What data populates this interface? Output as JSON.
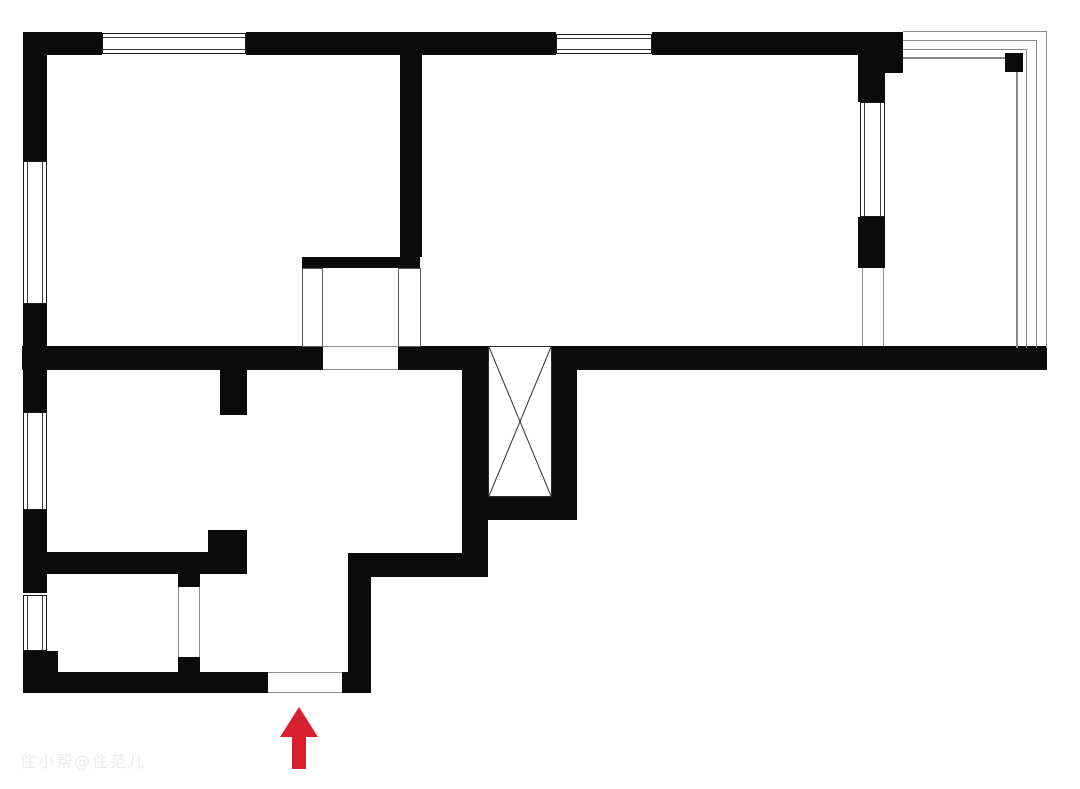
{
  "canvas": {
    "width": 1080,
    "height": 789,
    "background": "#ffffff"
  },
  "colors": {
    "wall": "#0b0b0b",
    "window_frame": "#1a1a1a",
    "window_inner": "#3a3a3a",
    "thin_line": "#909090",
    "light_wall_border": "#5a5a5a",
    "shaft_line": "#2a2a2a",
    "balcony_line": "#8a8a8a",
    "arrow": "#d71f2f",
    "watermark": "#ececec"
  },
  "watermark": {
    "text": "住小帮@住范儿"
  },
  "arrow": {
    "tip_x": 299,
    "tip_y": 707,
    "half_head": 19,
    "head_h": 30,
    "shaft_w": 14,
    "shaft_h": 32
  },
  "walls": [
    {
      "x": 23,
      "y": 32,
      "w": 79,
      "h": 23
    },
    {
      "x": 246,
      "y": 32,
      "w": 310,
      "h": 23
    },
    {
      "x": 652,
      "y": 32,
      "w": 251,
      "h": 23
    },
    {
      "x": 858,
      "y": 55,
      "w": 45,
      "h": 18
    },
    {
      "x": 858,
      "y": 73,
      "w": 27,
      "h": 29
    },
    {
      "x": 858,
      "y": 217,
      "w": 27,
      "h": 51
    },
    {
      "x": 23,
      "y": 32,
      "w": 24,
      "h": 129
    },
    {
      "x": 23,
      "y": 304,
      "w": 24,
      "h": 108
    },
    {
      "x": 23,
      "y": 510,
      "w": 24,
      "h": 83
    },
    {
      "x": 23,
      "y": 651,
      "w": 24,
      "h": 42
    },
    {
      "x": 47,
      "y": 651,
      "w": 11,
      "h": 21
    },
    {
      "x": 400,
      "y": 55,
      "w": 22,
      "h": 202
    },
    {
      "x": 302,
      "y": 257,
      "w": 118,
      "h": 11
    },
    {
      "x": 22,
      "y": 346,
      "w": 301,
      "h": 24
    },
    {
      "x": 398,
      "y": 346,
      "w": 64,
      "h": 24
    },
    {
      "x": 577,
      "y": 346,
      "w": 470,
      "h": 24
    },
    {
      "x": 462,
      "y": 346,
      "w": 26,
      "h": 230
    },
    {
      "x": 552,
      "y": 346,
      "w": 25,
      "h": 174
    },
    {
      "x": 488,
      "y": 497,
      "w": 89,
      "h": 23
    },
    {
      "x": 220,
      "y": 370,
      "w": 27,
      "h": 45
    },
    {
      "x": 208,
      "y": 530,
      "w": 39,
      "h": 44
    },
    {
      "x": 23,
      "y": 552,
      "w": 224,
      "h": 22
    },
    {
      "x": 348,
      "y": 553,
      "w": 140,
      "h": 24
    },
    {
      "x": 348,
      "y": 553,
      "w": 23,
      "h": 140
    },
    {
      "x": 23,
      "y": 672,
      "w": 245,
      "h": 21
    },
    {
      "x": 342,
      "y": 672,
      "w": 28,
      "h": 21
    },
    {
      "x": 178,
      "y": 574,
      "w": 22,
      "h": 13
    },
    {
      "x": 178,
      "y": 657,
      "w": 22,
      "h": 15
    }
  ],
  "windows": [
    {
      "x": 102,
      "y": 33,
      "w": 144,
      "h": 21,
      "o": "h"
    },
    {
      "x": 556,
      "y": 34,
      "w": 96,
      "h": 20,
      "o": "h"
    },
    {
      "x": 23,
      "y": 161,
      "w": 24,
      "h": 143,
      "o": "v"
    },
    {
      "x": 23,
      "y": 412,
      "w": 24,
      "h": 98,
      "o": "v"
    },
    {
      "x": 23,
      "y": 595,
      "w": 24,
      "h": 56,
      "o": "v"
    },
    {
      "x": 860,
      "y": 102,
      "w": 25,
      "h": 115,
      "o": "v"
    }
  ],
  "light_walls": [
    {
      "x": 302,
      "y": 268,
      "w": 21,
      "h": 79
    },
    {
      "x": 398,
      "y": 268,
      "w": 23,
      "h": 79
    }
  ],
  "openings": [
    {
      "x": 268,
      "y": 672,
      "w": 74,
      "h": 21,
      "edges": "tb"
    },
    {
      "x": 178,
      "y": 587,
      "w": 22,
      "h": 70,
      "edges": "lr"
    },
    {
      "x": 862,
      "y": 268,
      "w": 22,
      "h": 78,
      "edges": "lr"
    }
  ],
  "lines": [
    {
      "x": 323,
      "y": 346,
      "w": 75,
      "h": 1
    },
    {
      "x": 323,
      "y": 369,
      "w": 75,
      "h": 1
    }
  ],
  "balcony": {
    "start_x": 903,
    "wall_y": 348,
    "lines": [
      {
        "x": 1046,
        "y": 31,
        "t": 1
      },
      {
        "x": 1036,
        "y": 40,
        "t": 1
      },
      {
        "x": 1026,
        "y": 49,
        "t": 1
      },
      {
        "x": 1016,
        "y": 57,
        "t": 2
      }
    ]
  },
  "column": {
    "x": 1005,
    "y": 53,
    "w": 18,
    "h": 19
  },
  "shaft": {
    "x": 488,
    "y": 346,
    "w": 64,
    "h": 151
  }
}
